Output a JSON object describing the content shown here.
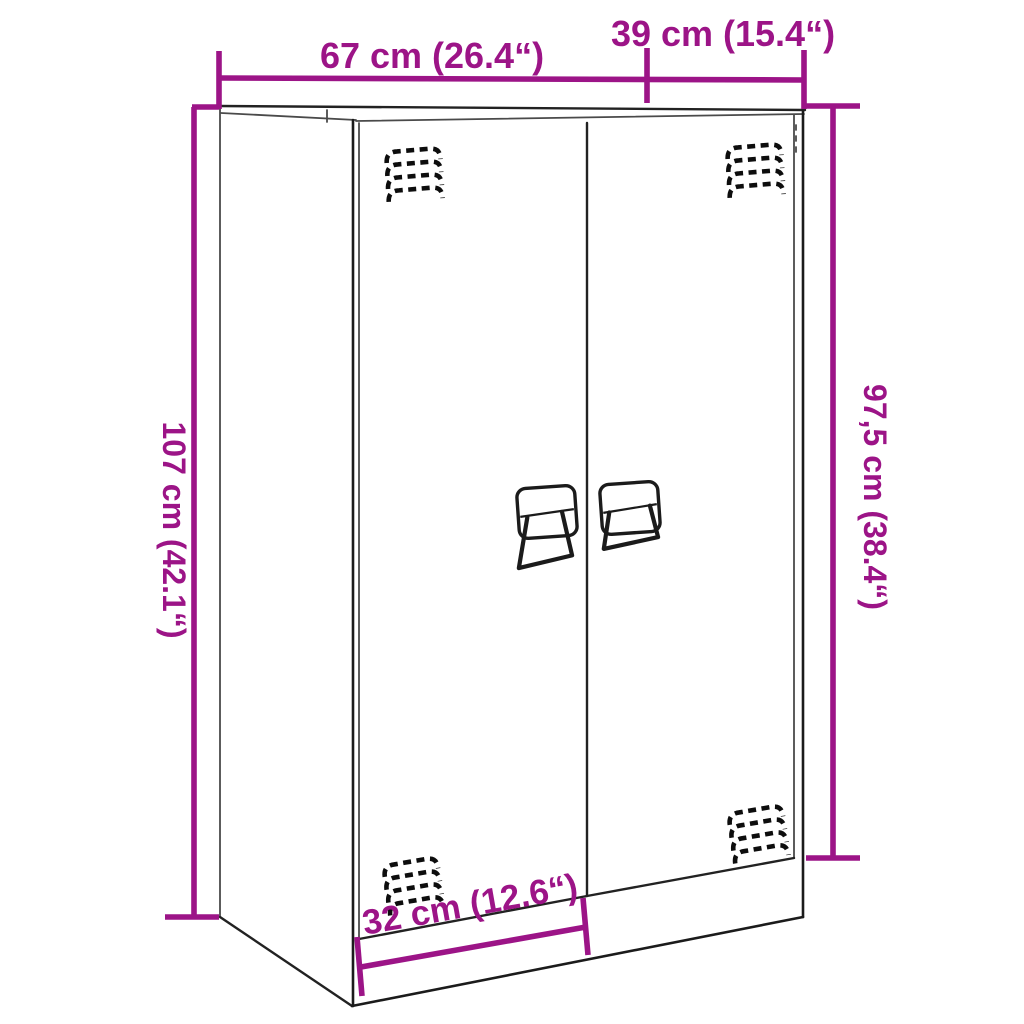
{
  "page": {
    "background": "#ffffff",
    "description_label": "furniture-dimension-diagram"
  },
  "colors": {
    "dimension": "#9C1487",
    "outline": "#222222",
    "vent": "#0d0d0d"
  },
  "dimensions": {
    "width": {
      "label": "67 cm (26.4“)",
      "value_cm": "67",
      "value_in": "26.4"
    },
    "depth": {
      "label": "39 cm (15.4“)",
      "value_cm": "39",
      "value_in": "15.4"
    },
    "height": {
      "label": "107 cm (42.1“)",
      "value_cm": "107",
      "value_in": "42.1"
    },
    "side_height": {
      "label": "97,5 cm (38.4“)",
      "value_cm": "97,5",
      "value_in": "38.4"
    },
    "door_width": {
      "label": "32 cm (12.6“)",
      "value_cm": "32",
      "value_in": "12.6"
    }
  }
}
